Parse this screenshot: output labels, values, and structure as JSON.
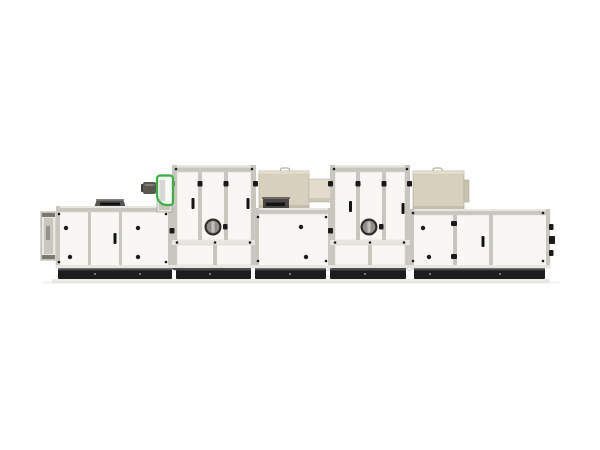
{
  "scene": {
    "subject": "Modular industrial air handling / dehumidification unit, side elevation product photo",
    "view": "side elevation",
    "background_description": "plain white studio background"
  },
  "colors": {
    "background": "#ffffff",
    "panel": "#f8f7f3",
    "panel_edge": "#d7d5ce",
    "frame": "#c8c6bf",
    "frame_light": "#e8e6e1",
    "frame_dark": "#94928a",
    "base_dark": "#1d1d1f",
    "base_highlight": "#4b4b4d",
    "beige": "#d7d0bf",
    "beige_light": "#e2dccc",
    "beige_shadow": "#b7af9c",
    "louver_gray": "#4a4843",
    "slot_black": "#141414",
    "fan_green": "#35b240",
    "fan_body": "#f2f2ef",
    "motor_gray": "#5a5751",
    "porthole_ring": "#2e2d2a",
    "porthole_glass": "#908e87",
    "fitting_black": "#1b1b1b",
    "shadow": "#d9d8d4"
  }
}
